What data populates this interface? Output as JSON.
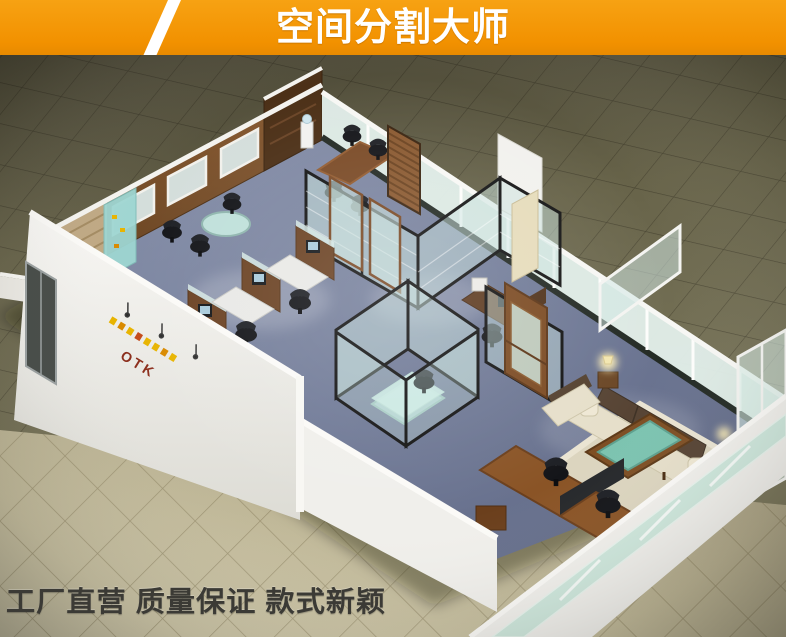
{
  "page": {
    "width": 786,
    "height": 637
  },
  "banner": {
    "title": "空间分割大师",
    "bg_color": "#F29100",
    "stripe_color": "#FFFFFF",
    "text_color": "#FFFFFF"
  },
  "footer": {
    "slogan": "工厂直营 质量保证 款式新颖",
    "text_color": "#3B3A35"
  },
  "scene": {
    "logo_text": "OTK",
    "colors": {
      "floor_tiles_dark": "#5E5A46",
      "floor_tiles_light": "#BCB495",
      "office_carpet": "#76809B",
      "partition_glass": "#D8E9E4",
      "partition_frame_black": "#191919",
      "partition_frame_white": "#F4F3EF",
      "wood_cabinet": "#7A4F2A",
      "wall_white": "#F4F3EF",
      "sofa_cream": "#E6DFCA",
      "sofa_cushion_brown": "#574434",
      "coffee_table_glass_green": "#7CC3B0",
      "poster_cyan": "#9ED6D2",
      "logo_red": "#8C2F1D",
      "logo_yellow": "#E8B400"
    }
  }
}
